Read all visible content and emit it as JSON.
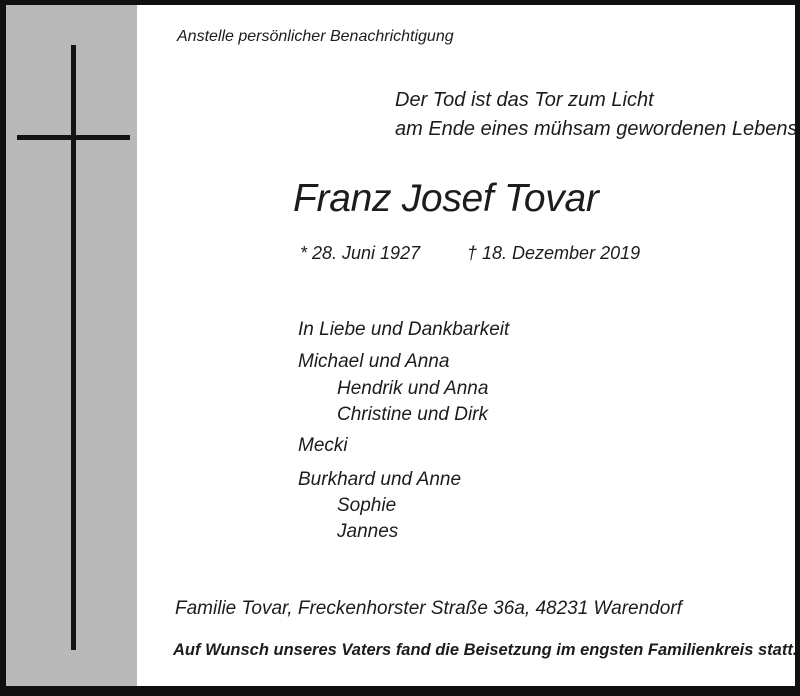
{
  "notice": {
    "intro": "Anstelle persönlicher Benachrichtigung",
    "epigraph": {
      "line1": "Der Tod ist das Tor zum Licht",
      "line2": "am Ende eines mühsam gewordenen Lebens."
    },
    "deceased": {
      "name": "Franz Josef Tovar",
      "birth": "* 28. Juni 1927",
      "death": "† 18. Dezember 2019"
    },
    "family": {
      "lead": "In Liebe und Dankbarkeit",
      "groups": [
        {
          "main": "Michael und Anna",
          "children": [
            "Hendrik und Anna",
            "Christine und Dirk"
          ]
        },
        {
          "main": "Mecki",
          "children": []
        },
        {
          "main": "Burkhard und Anne",
          "children": [
            "Sophie",
            "Jannes"
          ]
        }
      ]
    },
    "address": "Familie Tovar, Freckenhorster Straße 36a, 48231 Warendorf",
    "closing": "Auf Wunsch unseres Vaters fand die Beisetzung im engsten Familienkreis statt."
  },
  "colors": {
    "band": "#b9b9b9",
    "border": "#101010",
    "background": "#ffffff",
    "text": "#1c1c1c"
  }
}
